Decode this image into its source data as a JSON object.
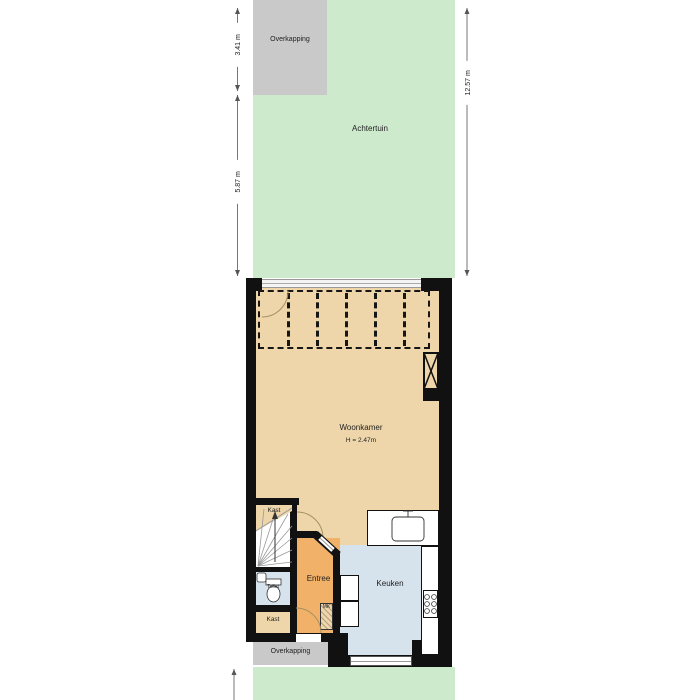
{
  "plan": {
    "garden": {
      "label": "Achtertuin"
    },
    "canopy_top": {
      "label": "Overkapping"
    },
    "canopy_bottom": {
      "label": "Overkapping"
    },
    "living_room": {
      "label": "Woonkamer",
      "ceiling_height": "H = 2.47m"
    },
    "kitchen": {
      "label": "Keuken"
    },
    "entry": {
      "label": "Entree"
    },
    "closet_upper": {
      "label": "Kast"
    },
    "closet_lower": {
      "label": "Kast"
    },
    "toilet": {
      "label": "Toilet"
    },
    "meter_closet": {
      "label": "MK"
    }
  },
  "dimensions": {
    "left_upper": "3.41 m",
    "left_lower": "5.87 m",
    "right": "12.57 m"
  },
  "colors": {
    "garden_green": "#cdeacd",
    "canopy_gray": "#c9c9c9",
    "living_tan": "#eed6aa",
    "entry_orange": "#f2b168",
    "kitchen_blue": "#d6e3ed",
    "wall_black": "#111111"
  }
}
